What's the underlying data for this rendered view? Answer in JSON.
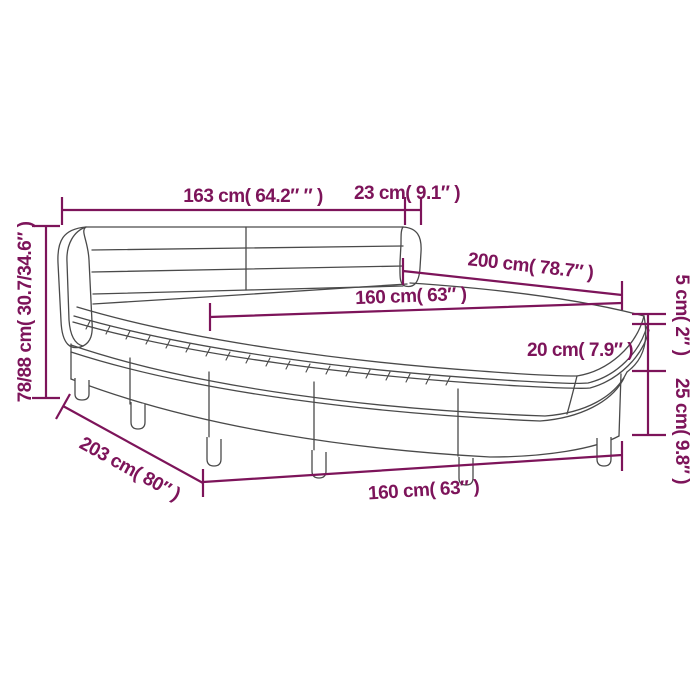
{
  "diagram": {
    "subject": "box-spring-bed-with-mattress-dimension-diagram",
    "colors": {
      "dimension_accent": "#7D145A",
      "drawing_line": "#4a4a4a",
      "background": "#ffffff"
    },
    "dimensions": {
      "headboard_width": {
        "label": "163 cm( 64.2″ ″ )"
      },
      "headboard_overhang": {
        "label": "23 cm( 9.1″ )"
      },
      "overall_height": {
        "label": "78/88 cm( 30.7/34.6″ )"
      },
      "bed_length": {
        "label": "200 cm( 78.7″ )"
      },
      "mattress_width": {
        "label": "160 cm( 63″ )"
      },
      "topper_thickness": {
        "label": "5 cm( 2″ )"
      },
      "mattress_thickness": {
        "label": "20 cm( 7.9″ )"
      },
      "base_height": {
        "label": "25 cm( 9.8″ )"
      },
      "frame_length": {
        "label": "203 cm( 80″ )"
      },
      "frame_width": {
        "label": "160 cm( 63″ )"
      }
    }
  }
}
